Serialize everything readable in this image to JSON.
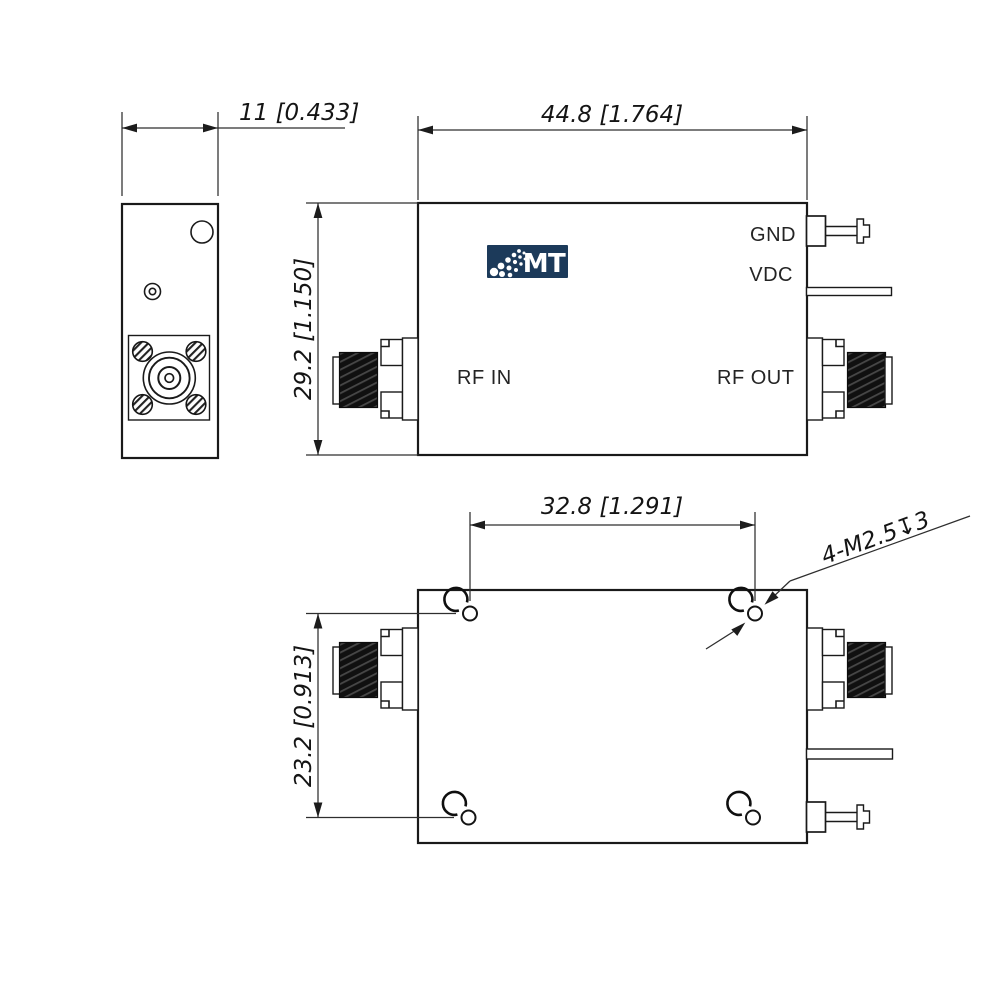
{
  "logo": {
    "text": "MT",
    "bg_color": "#1c3a5a",
    "fg_color": "#ffffff"
  },
  "port_labels": {
    "gnd": "GND",
    "vdc": "VDC",
    "rf_in": "RF IN",
    "rf_out": "RF OUT"
  },
  "dimensions": {
    "side_width": "11 [0.433]",
    "body_width": "44.8 [1.764]",
    "body_height": "29.2 [1.150]",
    "hole_spacing_x": "32.8 [1.291]",
    "hole_spacing_y": "23.2 [0.913]",
    "mounting_holes_callout": "4-M2.5↧3"
  },
  "colors": {
    "outline": "#1a1a1a",
    "dimension": "#2e2e2e",
    "background": "#ffffff"
  }
}
